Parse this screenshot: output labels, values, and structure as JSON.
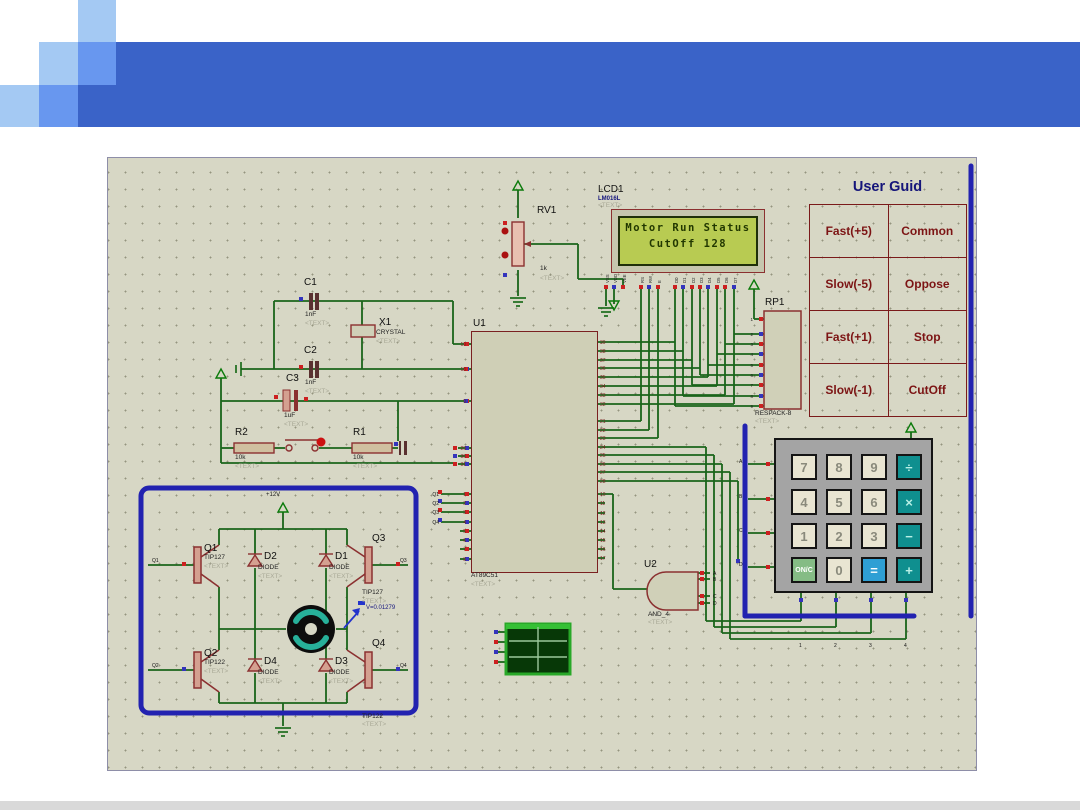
{
  "placeholder": "<TEXT>",
  "colors": {
    "header_dark": "#3a63c8",
    "header_mid": "#6897ef",
    "header_light": "#a4c9f3",
    "wire_green": "#1a651a",
    "highlight_blue": "#2222b0",
    "component_red": "#8b3030",
    "lcd_screen": "#b8cb52",
    "lcd_text": "#223800",
    "keypad_teal": "#0f8f8f",
    "keypad_equals": "#2e9fd4",
    "keypad_onc": "#85bc85",
    "guide_text": "#7c1414",
    "guide_title": "#15157a"
  },
  "user_guide": {
    "title": "User Guid",
    "rows": [
      {
        "left": "Fast(+5)",
        "right": "Common"
      },
      {
        "left": "Slow(-5)",
        "right": "Oppose"
      },
      {
        "left": "Fast(+1)",
        "right": "Stop"
      },
      {
        "left": "Slow(-1)",
        "right": "CutOff"
      }
    ]
  },
  "lcd": {
    "ref": "LCD1",
    "part": "LM016L",
    "line1": "Motor Run Status",
    "line2": "CutOff  128",
    "pins": [
      "VSS",
      "VDD",
      "VEE",
      "RS",
      "RW",
      "E",
      "D0",
      "D1",
      "D2",
      "D3",
      "D4",
      "D5",
      "D6",
      "D7"
    ]
  },
  "pot": {
    "ref": "RV1",
    "value": "1k"
  },
  "crystal": {
    "ref": "X1",
    "part": "CRYSTAL"
  },
  "capacitors": [
    {
      "ref": "C1",
      "value": "1nF"
    },
    {
      "ref": "C2",
      "value": "1nF"
    },
    {
      "ref": "C3",
      "value": "1uF"
    }
  ],
  "resistors": [
    {
      "ref": "R2",
      "value": "10k"
    },
    {
      "ref": "R1",
      "value": "10k"
    }
  ],
  "mcu": {
    "ref": "U1",
    "part": "AT89C51",
    "left_pins": [
      {
        "num": "19",
        "label": "XTAL1"
      },
      {
        "num": "18",
        "label": "XTAL2"
      },
      {
        "num": "9",
        "label": "RST"
      },
      {
        "num": "29",
        "label": "PSEN",
        "bar": true
      },
      {
        "num": "30",
        "label": "ALE",
        "bar": true
      },
      {
        "num": "31",
        "label": "EA",
        "bar": true
      },
      {
        "num": "1",
        "label": "P1.0"
      },
      {
        "num": "2",
        "label": "P1.1"
      },
      {
        "num": "3",
        "label": "P1.2"
      },
      {
        "num": "4",
        "label": "P1.3"
      },
      {
        "num": "5",
        "label": "P1.4"
      },
      {
        "num": "6",
        "label": "P1.5"
      },
      {
        "num": "7",
        "label": "P1.6"
      },
      {
        "num": "8",
        "label": "P1.7"
      }
    ],
    "right_pins": [
      {
        "num": "39",
        "label": "P0.0/AD0"
      },
      {
        "num": "38",
        "label": "P0.1/AD1"
      },
      {
        "num": "37",
        "label": "P0.2/AD2"
      },
      {
        "num": "36",
        "label": "P0.3/AD3"
      },
      {
        "num": "35",
        "label": "P0.4/AD4"
      },
      {
        "num": "34",
        "label": "P0.5/AD5"
      },
      {
        "num": "33",
        "label": "P0.6/AD6"
      },
      {
        "num": "32",
        "label": "P0.7/AD7"
      },
      {
        "num": "21",
        "label": "P2.0/A8"
      },
      {
        "num": "22",
        "label": "P2.1/A9"
      },
      {
        "num": "23",
        "label": "P2.2/A10"
      },
      {
        "num": "24",
        "label": "P2.3/A11"
      },
      {
        "num": "25",
        "label": "P2.4/A12"
      },
      {
        "num": "26",
        "label": "P2.5/A13"
      },
      {
        "num": "27",
        "label": "P2.6/A14"
      },
      {
        "num": "28",
        "label": "P2.7/A15"
      },
      {
        "num": "10",
        "label": "P3.0/RXD"
      },
      {
        "num": "11",
        "label": "P3.1/TXD"
      },
      {
        "num": "12",
        "label": "P3.2/INT0"
      },
      {
        "num": "13",
        "label": "P3.3/INT1"
      },
      {
        "num": "14",
        "label": "P3.4/T0"
      },
      {
        "num": "15",
        "label": "P3.5/T1"
      },
      {
        "num": "16",
        "label": "P3.6/WR"
      },
      {
        "num": "17",
        "label": "P3.7/RD"
      }
    ]
  },
  "net_labels": {
    "p1": [
      "Q1",
      "Q2",
      "Q3",
      "Q4"
    ],
    "hbridge_left": [
      "Q1",
      "Q2"
    ],
    "hbridge_right": [
      "Q3",
      "Q4"
    ],
    "keypad_rows": [
      "A",
      "B",
      "C",
      "D"
    ],
    "keypad_cols": [
      "1",
      "2",
      "3",
      "4"
    ],
    "and_inputs": [
      "A",
      "B",
      "C",
      "D"
    ]
  },
  "hbridge": {
    "supply": "+12V",
    "probe": "V=0.01279",
    "transistors": [
      {
        "ref": "Q1",
        "part": "TIP127"
      },
      {
        "ref": "Q3",
        "part": "TIP127"
      },
      {
        "ref": "Q2",
        "part": "TIP122"
      },
      {
        "ref": "Q4",
        "part": "TIP122"
      }
    ],
    "diodes": [
      {
        "ref": "D2",
        "part": "DIODE"
      },
      {
        "ref": "D1",
        "part": "DIODE"
      },
      {
        "ref": "D4",
        "part": "DIODE"
      },
      {
        "ref": "D3",
        "part": "DIODE"
      }
    ]
  },
  "and_gate": {
    "ref": "U2",
    "part": "AND_4"
  },
  "respack": {
    "ref": "RP1",
    "part": "RESPACK-8",
    "pins": [
      "1",
      "2",
      "3",
      "4",
      "5",
      "6",
      "7",
      "8",
      "9"
    ]
  },
  "keypad": {
    "keys": [
      {
        "label": "7",
        "type": "num"
      },
      {
        "label": "8",
        "type": "num"
      },
      {
        "label": "9",
        "type": "num"
      },
      {
        "label": "÷",
        "type": "op"
      },
      {
        "label": "4",
        "type": "num"
      },
      {
        "label": "5",
        "type": "num"
      },
      {
        "label": "6",
        "type": "num"
      },
      {
        "label": "×",
        "type": "op"
      },
      {
        "label": "1",
        "type": "num"
      },
      {
        "label": "2",
        "type": "num"
      },
      {
        "label": "3",
        "type": "num"
      },
      {
        "label": "−",
        "type": "op"
      },
      {
        "label": "ON/C",
        "type": "onc"
      },
      {
        "label": "0",
        "type": "num"
      },
      {
        "label": "=",
        "type": "eq"
      },
      {
        "label": "+",
        "type": "op"
      }
    ]
  }
}
